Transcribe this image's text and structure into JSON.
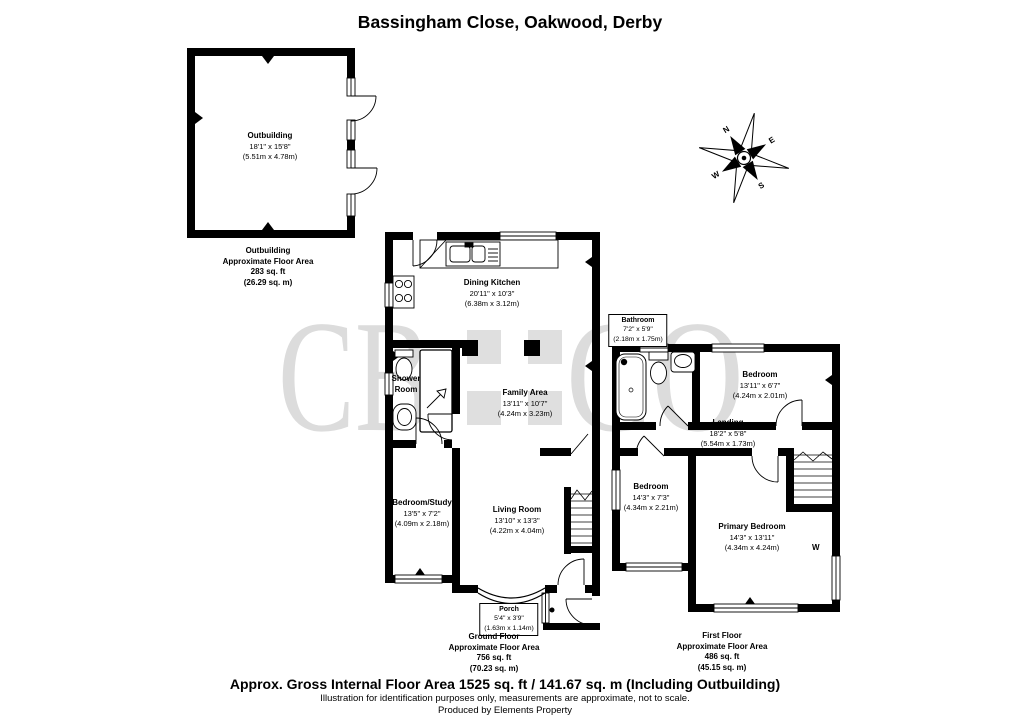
{
  "title": "Bassingham Close, Oakwood, Derby",
  "watermark": {
    "left": "CB",
    "right": "CO",
    "color": "#dcdcdc"
  },
  "colors": {
    "walls": "#000000",
    "background": "#ffffff"
  },
  "compass": {
    "n": "N",
    "e": "E",
    "s": "S",
    "w": "W"
  },
  "outbuilding": {
    "label": {
      "name": "Outbuilding",
      "dims_ft": "18'1\" x 15'8\"",
      "dims_m": "(5.51m x 4.78m)"
    },
    "caption": {
      "floor": "Outbuilding",
      "area_title": "Approximate Floor Area",
      "area_ft": "283 sq. ft",
      "area_m": "(26.29 sq. m)"
    }
  },
  "ground_floor": {
    "dining_kitchen": {
      "name": "Dining Kitchen",
      "dims_ft": "20'11\" x 10'3\"",
      "dims_m": "(6.38m x 3.12m)"
    },
    "shower_room": {
      "name_line1": "Shower",
      "name_line2": "Room"
    },
    "family_area": {
      "name": "Family Area",
      "dims_ft": "13'11\" x 10'7\"",
      "dims_m": "(4.24m x 3.23m)"
    },
    "bedroom_study": {
      "name": "Bedroom/Study",
      "dims_ft": "13'5\" x 7'2\"",
      "dims_m": "(4.09m x 2.18m)"
    },
    "living_room": {
      "name": "Living Room",
      "dims_ft": "13'10\" x 13'3\"",
      "dims_m": "(4.22m x 4.04m)"
    },
    "porch": {
      "name": "Porch",
      "dims_ft": "5'4\" x 3'9\"",
      "dims_m": "(1.63m x 1.14m)"
    },
    "caption": {
      "floor": "Ground Floor",
      "area_title": "Approximate Floor Area",
      "area_ft": "756 sq. ft",
      "area_m": "(70.23 sq. m)"
    }
  },
  "first_floor": {
    "bathroom": {
      "name": "Bathroom",
      "dims_ft": "7'2\" x 5'9\"",
      "dims_m": "(2.18m x 1.75m)"
    },
    "bedroom_front": {
      "name": "Bedroom",
      "dims_ft": "13'11\" x 6'7\"",
      "dims_m": "(4.24m x 2.01m)"
    },
    "landing": {
      "name": "Landing",
      "dims_ft": "18'2\" x 5'8\"",
      "dims_m": "(5.54m x 1.73m)"
    },
    "bedroom_rear": {
      "name": "Bedroom",
      "dims_ft": "14'3\" x 7'3\"",
      "dims_m": "(4.34m x 2.21m)"
    },
    "primary_bedroom": {
      "name": "Primary Bedroom",
      "dims_ft": "14'3\" x 13'11\"",
      "dims_m": "(4.34m x 4.24m)"
    },
    "wardrobe_label": "W",
    "caption": {
      "floor": "First Floor",
      "area_title": "Approximate Floor Area",
      "area_ft": "486 sq. ft",
      "area_m": "(45.15 sq. m)"
    }
  },
  "footer": {
    "summary": "Approx. Gross Internal Floor Area 1525 sq. ft / 141.67 sq. m (Including Outbuilding)",
    "disclaimer": "Illustration for identification purposes only, measurements are approximate, not to scale.",
    "producer": "Produced by Elements Property"
  }
}
